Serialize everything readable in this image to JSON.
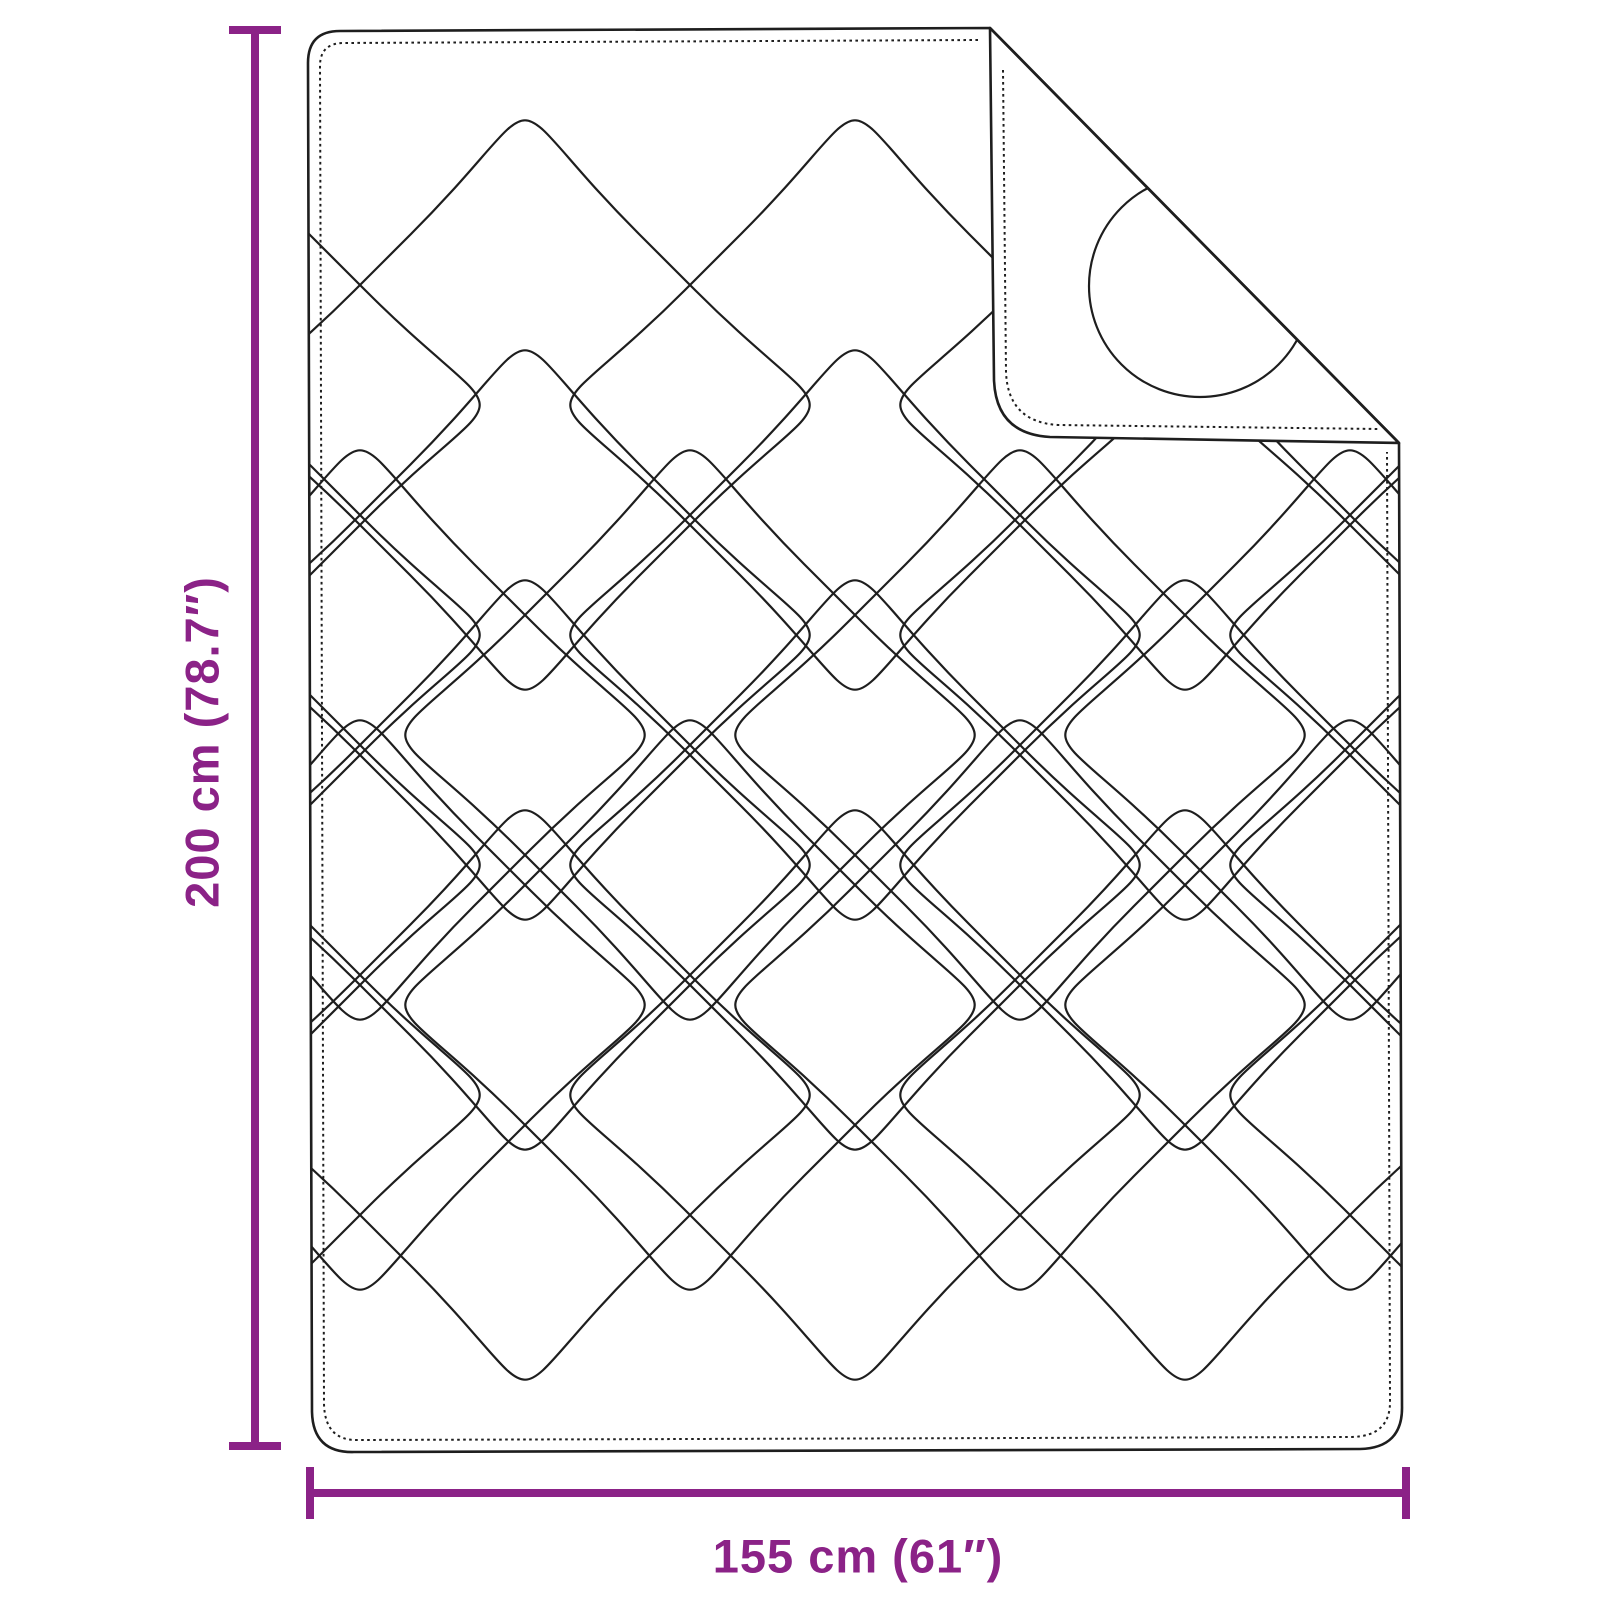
{
  "diagram": {
    "title": "Quilted blanket dimension diagram",
    "product": "Quilted blanket with folded top-right corner",
    "height_label": "200 cm (78.7″)",
    "width_label": "155 cm (61″)",
    "accent_color": "#8b2287",
    "line_color": "#1e1e1e",
    "background_color": "#ffffff"
  }
}
